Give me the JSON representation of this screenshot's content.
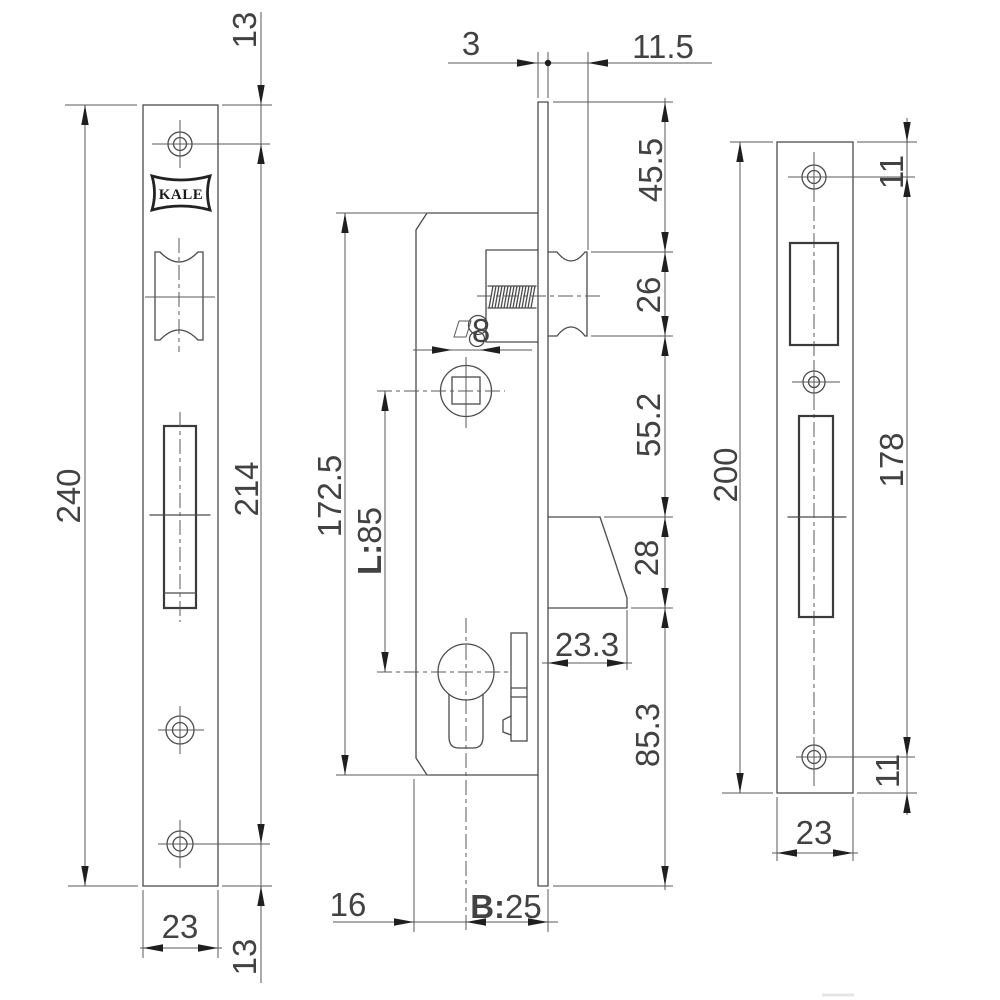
{
  "brand_mark": "KALE",
  "views": {
    "front_plate": {
      "dims": {
        "overall_height": "240",
        "hole_spacing": "214",
        "top_edge_to_hole": "13",
        "hole_to_bottom_edge": "13",
        "width": "23"
      }
    },
    "body_side": {
      "dims": {
        "plate_thickness": "3",
        "roller_projection": "11.5",
        "plate_top_to_roller": "45.5",
        "roller_height": "26",
        "roller_to_bolt": "55.2",
        "bolt_height": "28",
        "bolt_to_plate_bottom": "85.3",
        "case_height": "172.5",
        "centre_distance_label": "L:",
        "centre_distance_value": "85",
        "spindle_size": "8",
        "bolt_throw": "23.3",
        "case_edge_to_centre": "16",
        "backset_label": "B:",
        "backset_value": "25"
      }
    },
    "strike_plate": {
      "dims": {
        "overall_height": "200",
        "hole_spacing": "178",
        "top_edge_to_hole": "11",
        "hole_to_bottom_edge": "11",
        "width": "23"
      }
    }
  }
}
